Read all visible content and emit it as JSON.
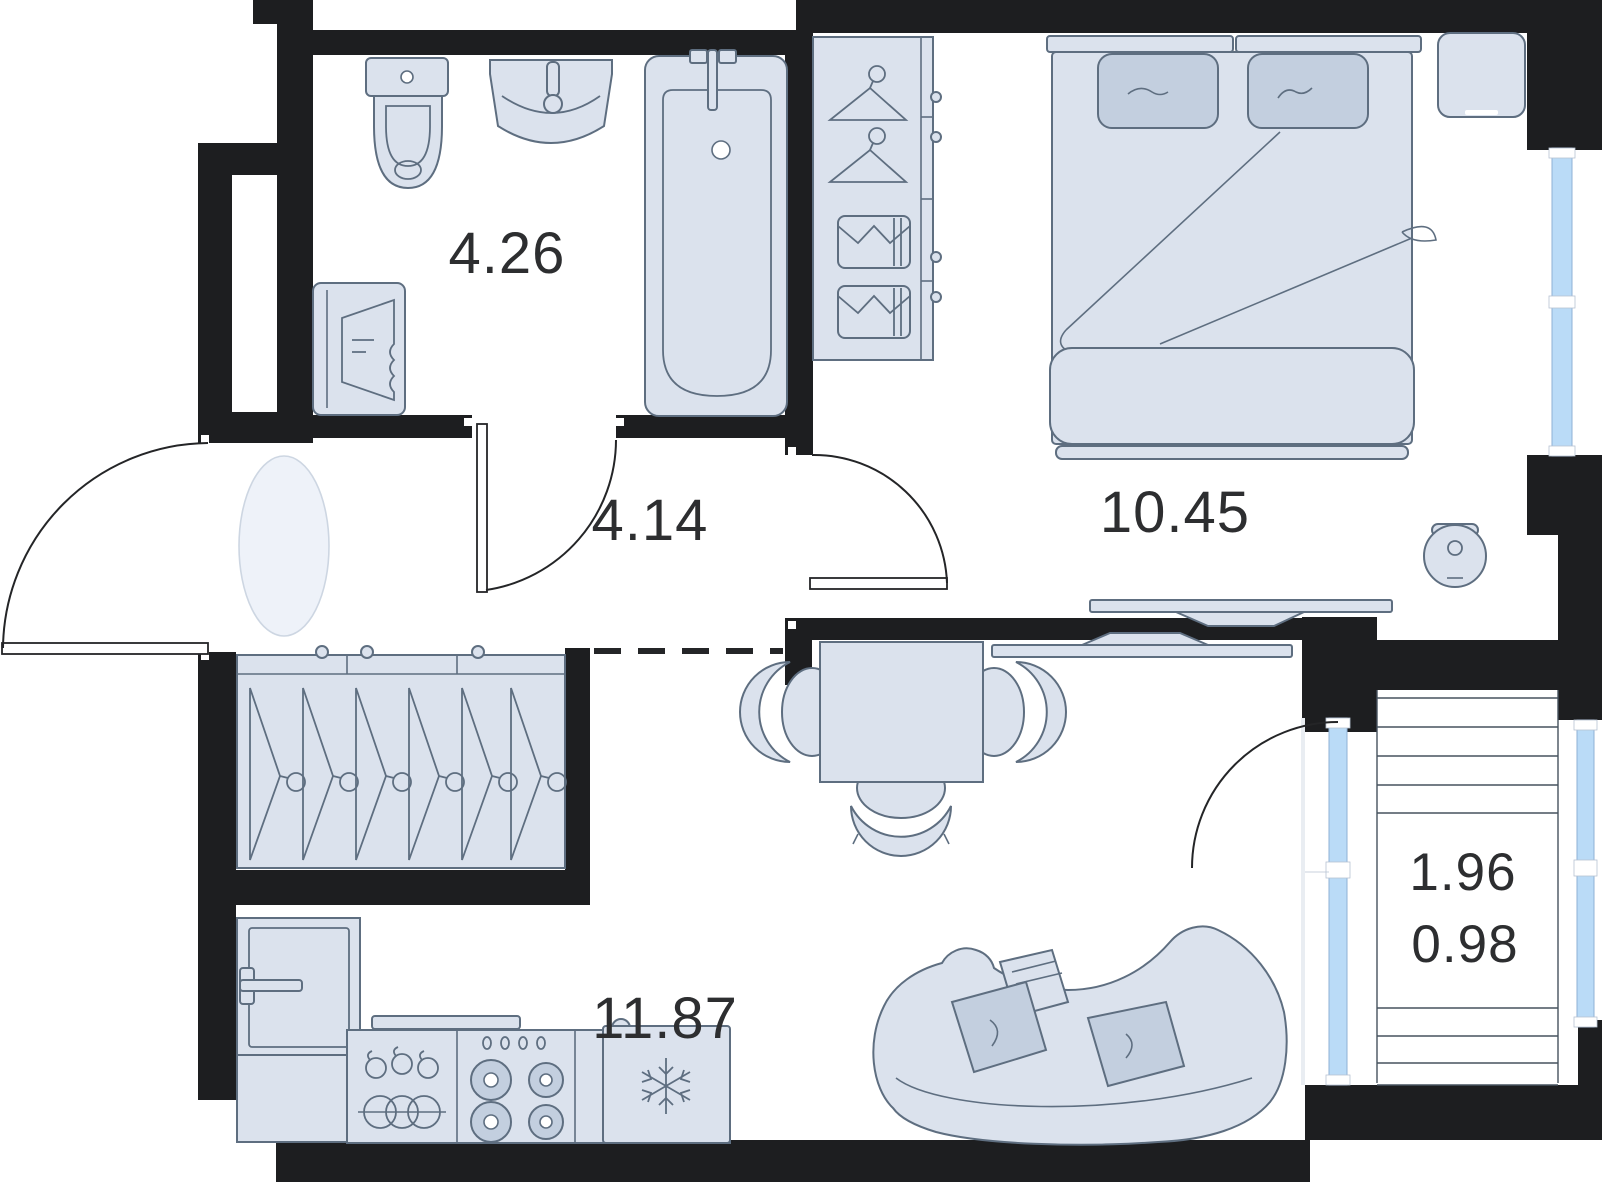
{
  "theme": {
    "floor": "#ffffff",
    "wall": "#1d1e20",
    "furniture": "#dbe2ed",
    "furniture_light": "#eef2f9",
    "accent": "#c3cfdf",
    "outline": "#5e6e80",
    "glass": "#badbf7",
    "glass_stroke": "#8fb0d6",
    "door_line": "#242527",
    "balcony_line": "#46525e",
    "text": "#2d2e30"
  },
  "rooms": {
    "bathroom": {
      "label": "4.26"
    },
    "hallway": {
      "label": "4.14"
    },
    "bedroom": {
      "label": "10.45"
    },
    "living_kitchen": {
      "label": "11.87"
    },
    "balcony": {
      "area": "1.96",
      "reduced": "0.98"
    }
  }
}
